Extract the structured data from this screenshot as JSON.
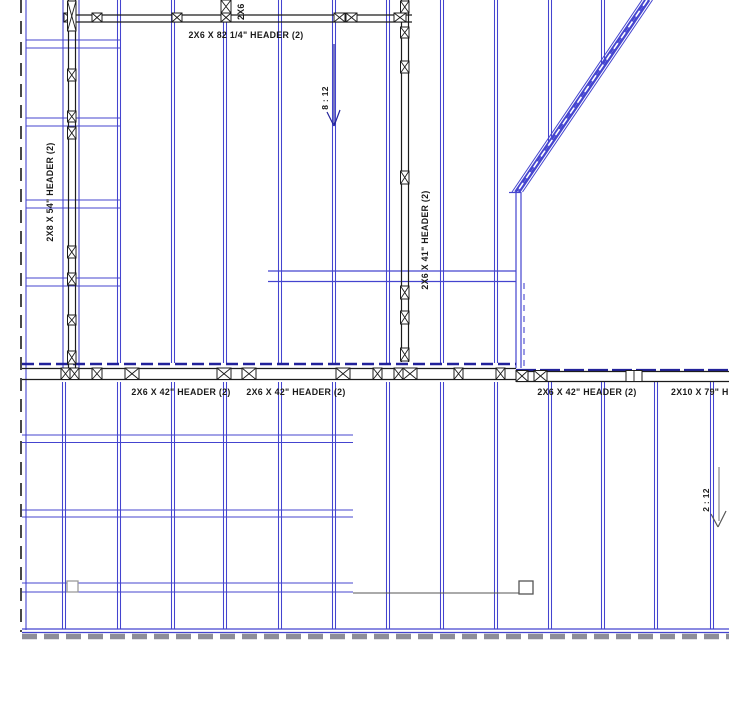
{
  "page": {
    "background": "#ffffff",
    "type_note": "wall and roof framing plan"
  },
  "colors": {
    "blue": "#4444cf",
    "navy": "#22229b",
    "black": "#1c1c1c",
    "gray": "#8d8d99",
    "lgray": "#9a9a9a",
    "dgray": "#555555",
    "white": "#ffffff",
    "text": "#1a1a1a"
  },
  "drawing": {
    "width": 729,
    "height": 710,
    "studs": [
      [
        119,
        0,
        363
      ],
      [
        173,
        0,
        363
      ],
      [
        225,
        0,
        363
      ],
      [
        280,
        0,
        363
      ],
      [
        334,
        0,
        363
      ],
      [
        388,
        0,
        363
      ],
      [
        442,
        0,
        363
      ],
      [
        496,
        0,
        363
      ],
      [
        550,
        0,
        143
      ],
      [
        603,
        0,
        63
      ],
      [
        64,
        382,
        629
      ],
      [
        119,
        382,
        629
      ],
      [
        173,
        382,
        629
      ],
      [
        225,
        382,
        629
      ],
      [
        280,
        382,
        629
      ],
      [
        334,
        382,
        629
      ],
      [
        388,
        382,
        629
      ],
      [
        442,
        382,
        629
      ],
      [
        496,
        382,
        629
      ],
      [
        550,
        382,
        629
      ],
      [
        603,
        382,
        629
      ],
      [
        656,
        382,
        629
      ],
      [
        712,
        382,
        629
      ]
    ],
    "lines": [
      [
        26,
        0,
        26,
        630,
        "blue",
        1.1,
        null
      ],
      [
        63,
        0,
        63,
        368,
        "blue",
        1.1,
        null
      ],
      [
        79,
        0,
        79,
        368,
        "blue",
        1.1,
        null
      ],
      [
        516,
        192,
        516,
        368,
        "blue",
        1.2,
        null
      ],
      [
        521,
        192,
        521,
        368,
        "blue",
        1.2,
        null
      ],
      [
        524,
        283,
        524,
        366,
        "blue",
        1.1,
        "6,5"
      ],
      [
        509,
        192.5,
        521,
        192.5,
        "blue",
        1.2,
        null
      ],
      [
        268,
        271,
        516,
        271,
        "blue",
        1.2,
        null
      ],
      [
        268,
        281.5,
        516,
        281.5,
        "blue",
        1.2,
        null
      ],
      [
        26,
        40,
        120,
        40,
        "blue",
        1.1,
        null
      ],
      [
        26,
        48,
        120,
        48,
        "blue",
        1.1,
        null
      ],
      [
        26,
        118,
        120,
        118,
        "blue",
        1.1,
        null
      ],
      [
        26,
        126,
        120,
        126,
        "blue",
        1.1,
        null
      ],
      [
        26,
        200,
        120,
        200,
        "blue",
        1.1,
        null
      ],
      [
        26,
        208,
        120,
        208,
        "blue",
        1.1,
        null
      ],
      [
        26,
        278,
        120,
        278,
        "blue",
        1.1,
        null
      ],
      [
        26,
        286,
        120,
        286,
        "blue",
        1.1,
        null
      ],
      [
        22,
        435,
        353,
        435,
        "blue",
        1.1,
        null
      ],
      [
        22,
        442.5,
        353,
        442.5,
        "blue",
        1.1,
        null
      ],
      [
        22,
        510,
        353,
        510,
        "blue",
        1.1,
        null
      ],
      [
        22,
        517,
        353,
        517,
        "blue",
        1.1,
        null
      ],
      [
        22,
        583,
        353,
        583,
        "blue",
        1.1,
        null
      ],
      [
        22,
        592,
        353,
        592,
        "blue",
        1.1,
        null
      ],
      [
        22,
        629,
        729,
        629,
        "blue",
        1.3,
        null
      ],
      [
        22,
        632.5,
        729,
        632.5,
        "blue",
        1.3,
        null
      ],
      [
        642,
        0,
        512,
        192,
        "blue",
        1,
        null
      ],
      [
        645.5,
        0,
        515.5,
        192,
        "blue",
        2.8,
        null
      ],
      [
        649,
        0,
        519,
        192,
        "blue",
        2.8,
        null
      ],
      [
        652.5,
        0,
        522.5,
        192,
        "blue",
        1,
        null
      ],
      [
        647,
        0,
        517,
        192,
        "white",
        1.6,
        "7,6"
      ],
      [
        22,
        364,
        516,
        364,
        "navy",
        2.6,
        "12,5"
      ],
      [
        516,
        370,
        729,
        370,
        "navy",
        2.2,
        "20,4"
      ],
      [
        334,
        44,
        334,
        124,
        "navy",
        1.2,
        null
      ],
      [
        327,
        112,
        334,
        126,
        "navy",
        1.2,
        null
      ],
      [
        340,
        110,
        334,
        126,
        "navy",
        1.2,
        null
      ],
      [
        67,
        15,
        412,
        15,
        "black",
        1.3,
        null
      ],
      [
        67,
        22,
        412,
        22,
        "black",
        1.3,
        null
      ],
      [
        68.5,
        0,
        68.5,
        368,
        "black",
        1.2,
        null
      ],
      [
        75.5,
        0,
        75.5,
        368,
        "black",
        1.2,
        null
      ],
      [
        401.5,
        0,
        401.5,
        362,
        "black",
        1.2,
        null
      ],
      [
        408.5,
        0,
        408.5,
        362,
        "black",
        1.2,
        null
      ],
      [
        22,
        368.5,
        516,
        368.5,
        "black",
        1.2,
        null
      ],
      [
        22,
        379.5,
        516,
        379.5,
        "black",
        1.2,
        null
      ],
      [
        516,
        371.5,
        729,
        371.5,
        "black",
        1.2,
        null
      ],
      [
        516,
        381.5,
        729,
        381.5,
        "black",
        1.2,
        null
      ],
      [
        21,
        0,
        21,
        632,
        "black",
        1.6,
        "13,8"
      ],
      [
        353,
        593,
        519,
        593,
        "dgray",
        1,
        null
      ],
      [
        22,
        636.5,
        729,
        636.5,
        "gray",
        5.5,
        "15,7"
      ],
      [
        719,
        467,
        719,
        521,
        "lgray",
        1.4,
        null
      ],
      [
        711,
        514,
        718,
        527,
        "dgray",
        1.2,
        null
      ],
      [
        726,
        511,
        718,
        527,
        "dgray",
        1.2,
        null
      ]
    ],
    "xboxes": [
      [
        64,
        13,
        12,
        9
      ],
      [
        92,
        13,
        10,
        9
      ],
      [
        172,
        13,
        10,
        9
      ],
      [
        221,
        13,
        10,
        9
      ],
      [
        221,
        0,
        10,
        13
      ],
      [
        334,
        13,
        11,
        9
      ],
      [
        346,
        13,
        11,
        9
      ],
      [
        394,
        13,
        12,
        9
      ],
      [
        67.5,
        1,
        8.5,
        30
      ],
      [
        67.5,
        69,
        8.5,
        12
      ],
      [
        67.5,
        111,
        8.5,
        11
      ],
      [
        67.5,
        127,
        8.5,
        12
      ],
      [
        67.5,
        246,
        8.5,
        12
      ],
      [
        67.5,
        273,
        8.5,
        12
      ],
      [
        67.5,
        315,
        8.5,
        10
      ],
      [
        67.5,
        351,
        8.5,
        13
      ],
      [
        400.5,
        1,
        8.5,
        12
      ],
      [
        400.5,
        27,
        8.5,
        11
      ],
      [
        400.5,
        61,
        8.5,
        12
      ],
      [
        400.5,
        171,
        8.5,
        13
      ],
      [
        400.5,
        286,
        8.5,
        13
      ],
      [
        400.5,
        311,
        8.5,
        13
      ],
      [
        400.5,
        348,
        8.5,
        13
      ],
      [
        61,
        368,
        9,
        11.5
      ],
      [
        70,
        368,
        9,
        11.5
      ],
      [
        92,
        368,
        10,
        11.5
      ],
      [
        125,
        368,
        14,
        11.5
      ],
      [
        217,
        368,
        14,
        11.5
      ],
      [
        242,
        368,
        14,
        11.5
      ],
      [
        336,
        368,
        14,
        11.5
      ],
      [
        373,
        368,
        9,
        11.5
      ],
      [
        394,
        368,
        9,
        11.5
      ],
      [
        403,
        368,
        14,
        11.5
      ],
      [
        454,
        368,
        9,
        11.5
      ],
      [
        496,
        368,
        9,
        11.5
      ],
      [
        516,
        370.5,
        12,
        11
      ],
      [
        534,
        370.5,
        13,
        11
      ]
    ],
    "plain_boxes": [
      [
        626,
        370.5,
        16,
        11
      ]
    ],
    "squares": [
      {
        "x": 67,
        "y": 581,
        "w": 11,
        "h": 11,
        "c": "lgray"
      },
      {
        "x": 519,
        "y": 581,
        "w": 14,
        "h": 13,
        "c": "dgray"
      }
    ],
    "labels": [
      {
        "id": "header-82",
        "text": "2X6 X 82 1/4\" HEADER (2)",
        "x": 246,
        "y": 38,
        "rot": 0,
        "anchor": "middle",
        "size": 8.8
      },
      {
        "id": "header-2x6-cut",
        "text": "2X6",
        "x": 244,
        "y": 20,
        "rot": -90,
        "anchor": "start",
        "size": 8.8
      },
      {
        "id": "header-54",
        "text": "2X8 X 54\" HEADER (2)",
        "x": 53,
        "y": 192,
        "rot": -90,
        "anchor": "middle",
        "size": 8.8
      },
      {
        "id": "header-41",
        "text": "2X6 X 41\" HEADER (2)",
        "x": 428,
        "y": 240,
        "rot": -90,
        "anchor": "middle",
        "size": 8.8
      },
      {
        "id": "slope-8-12",
        "text": "8 : 12",
        "x": 328,
        "y": 98,
        "rot": -90,
        "anchor": "middle",
        "size": 8.5
      },
      {
        "id": "header-42-a",
        "text": "2X6 X 42\" HEADER (2)",
        "x": 181,
        "y": 395,
        "rot": 0,
        "anchor": "middle",
        "size": 8.8
      },
      {
        "id": "header-42-b",
        "text": "2X6 X 42\" HEADER (2)",
        "x": 296,
        "y": 395,
        "rot": 0,
        "anchor": "middle",
        "size": 8.8
      },
      {
        "id": "header-42-c",
        "text": "2X6 X 42\" HEADER (2)",
        "x": 587,
        "y": 395,
        "rot": 0,
        "anchor": "middle",
        "size": 8.8
      },
      {
        "id": "header-79",
        "text": "2X10 X 79\" H",
        "x": 671,
        "y": 395,
        "rot": 0,
        "anchor": "start",
        "size": 8.8
      },
      {
        "id": "slope-2-12",
        "text": "2 : 12",
        "x": 709,
        "y": 500,
        "rot": -90,
        "anchor": "middle",
        "size": 8.5
      }
    ]
  }
}
